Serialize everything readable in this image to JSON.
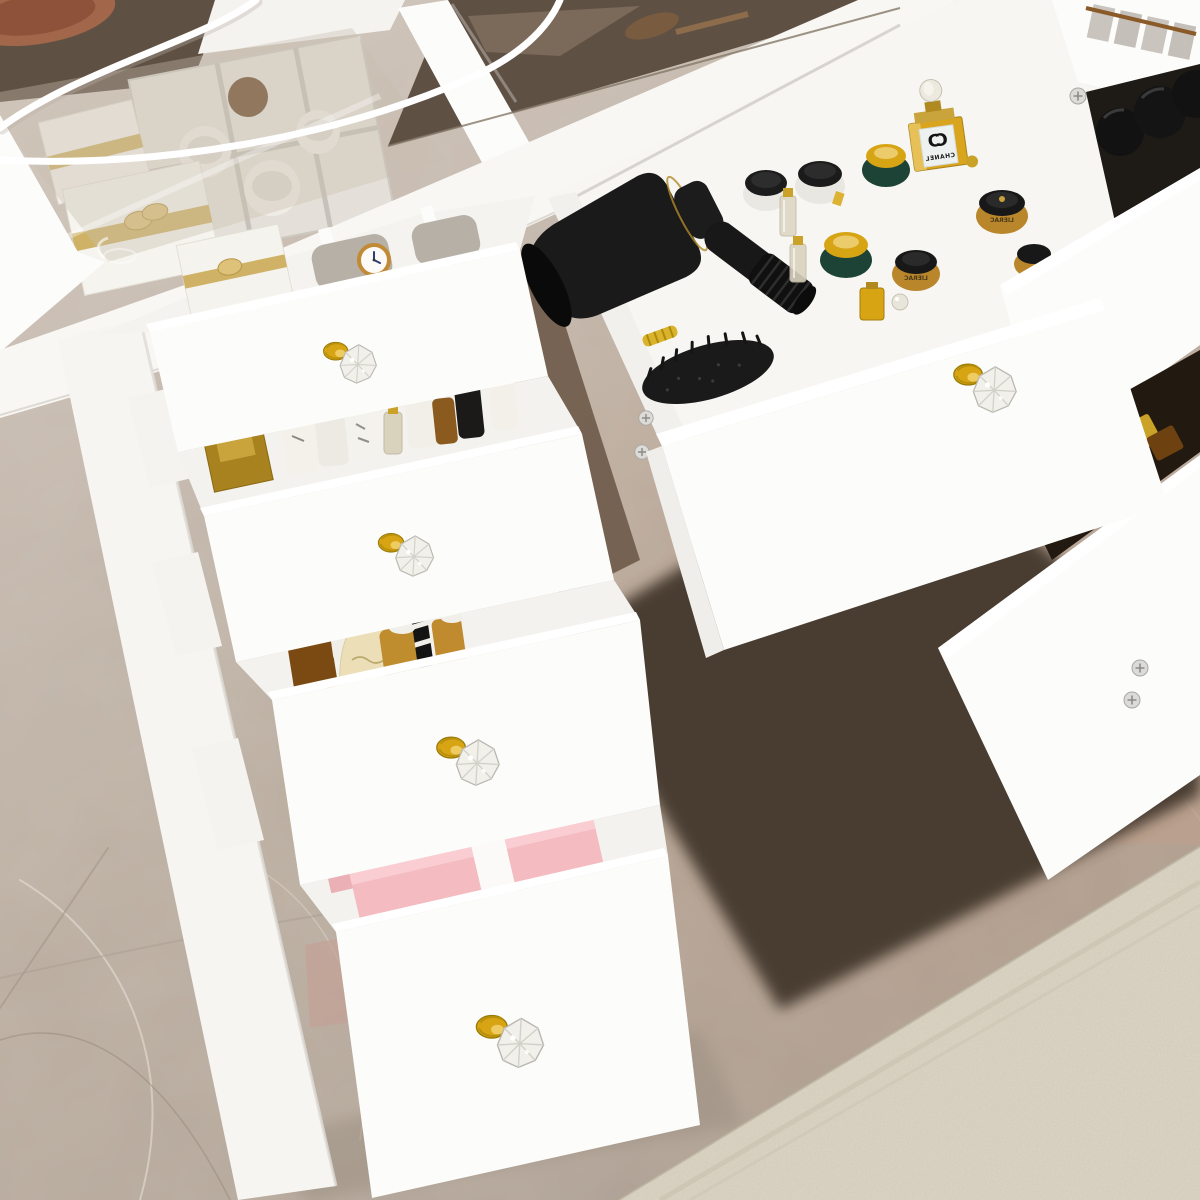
{
  "image": {
    "type": "product-photograph",
    "subject": "White vanity dressing table with tempered glass display top, crystal drawer knobs and open drawers organized with cosmetics and accessories",
    "view": "overhead three-quarter view",
    "setting": "grey-taupe marble tile floor with a beige carpet in the lower-right corner"
  },
  "labels": {
    "perfume_brand": "CHANEL",
    "logo_letter": "C",
    "jar_brand": "LIERAC"
  },
  "colors": {
    "white_furniture": "#fcfcfb",
    "marble_floor": "#c3b7ab",
    "floor_shadow": "#4a3d32",
    "gap_shadow": "#6e5a49",
    "rug": "#dcd5c5",
    "glass_tint": "#c9bcae",
    "dark_glass": "#5f5044",
    "gold": "#d7a414",
    "crystal": "#f1f0ea",
    "appliance_black": "#1a1a1a",
    "green_jar": "#1d4336",
    "amber": "#b9862c",
    "cream": "#ecdfb8",
    "pink_box": "#f4bcc1",
    "pillow_grey": "#b7b0a7",
    "watch_gold": "#c08a36",
    "copper": "#a2664a",
    "chanel_label": "#edf2f0",
    "chanel_liquid": "#d9a41e",
    "ribbon_gold": "#cfb266"
  },
  "furniture": {
    "drawer_knob": "clear crystal diamond knob with gold base",
    "visible_knobs": 5,
    "left_drawers_open": 4,
    "center_drawer_open": 1,
    "right_drawers_open": 3
  },
  "drawer_contents": {
    "glass_top_display": [
      "white gift boxes with gold ribbon",
      "divided organizer tray",
      "round cream jars",
      "amber glass bottle",
      "copper tray"
    ],
    "top_left_drawer": [
      "wrist watch with white dial",
      "grey watch pillows",
      "white gift box with gold ribbon"
    ],
    "second_left_drawer": [
      "gold perfume box",
      "white lotion bottles",
      "glass vials with gold caps",
      "black bottle"
    ],
    "third_left_drawer": [
      "cream pump bottle",
      "amber square flask with white ball cap",
      "striped black bottle",
      "amber bottles with white caps"
    ],
    "bottom_left_drawer": [
      "pink gift box with white ribbon"
    ],
    "center_drawer": [
      "black hair dryer",
      "black paddle hair brush",
      "green jars with gold lids",
      "white jars with black lids",
      "amber jars with black lids",
      "perfume bottle",
      "glass vials",
      "gold flask"
    ],
    "right_drawers": [
      "black cosmetic bottles",
      "amber perfume bottles",
      "gold bottle with ring cap",
      "white spray bottle"
    ]
  }
}
